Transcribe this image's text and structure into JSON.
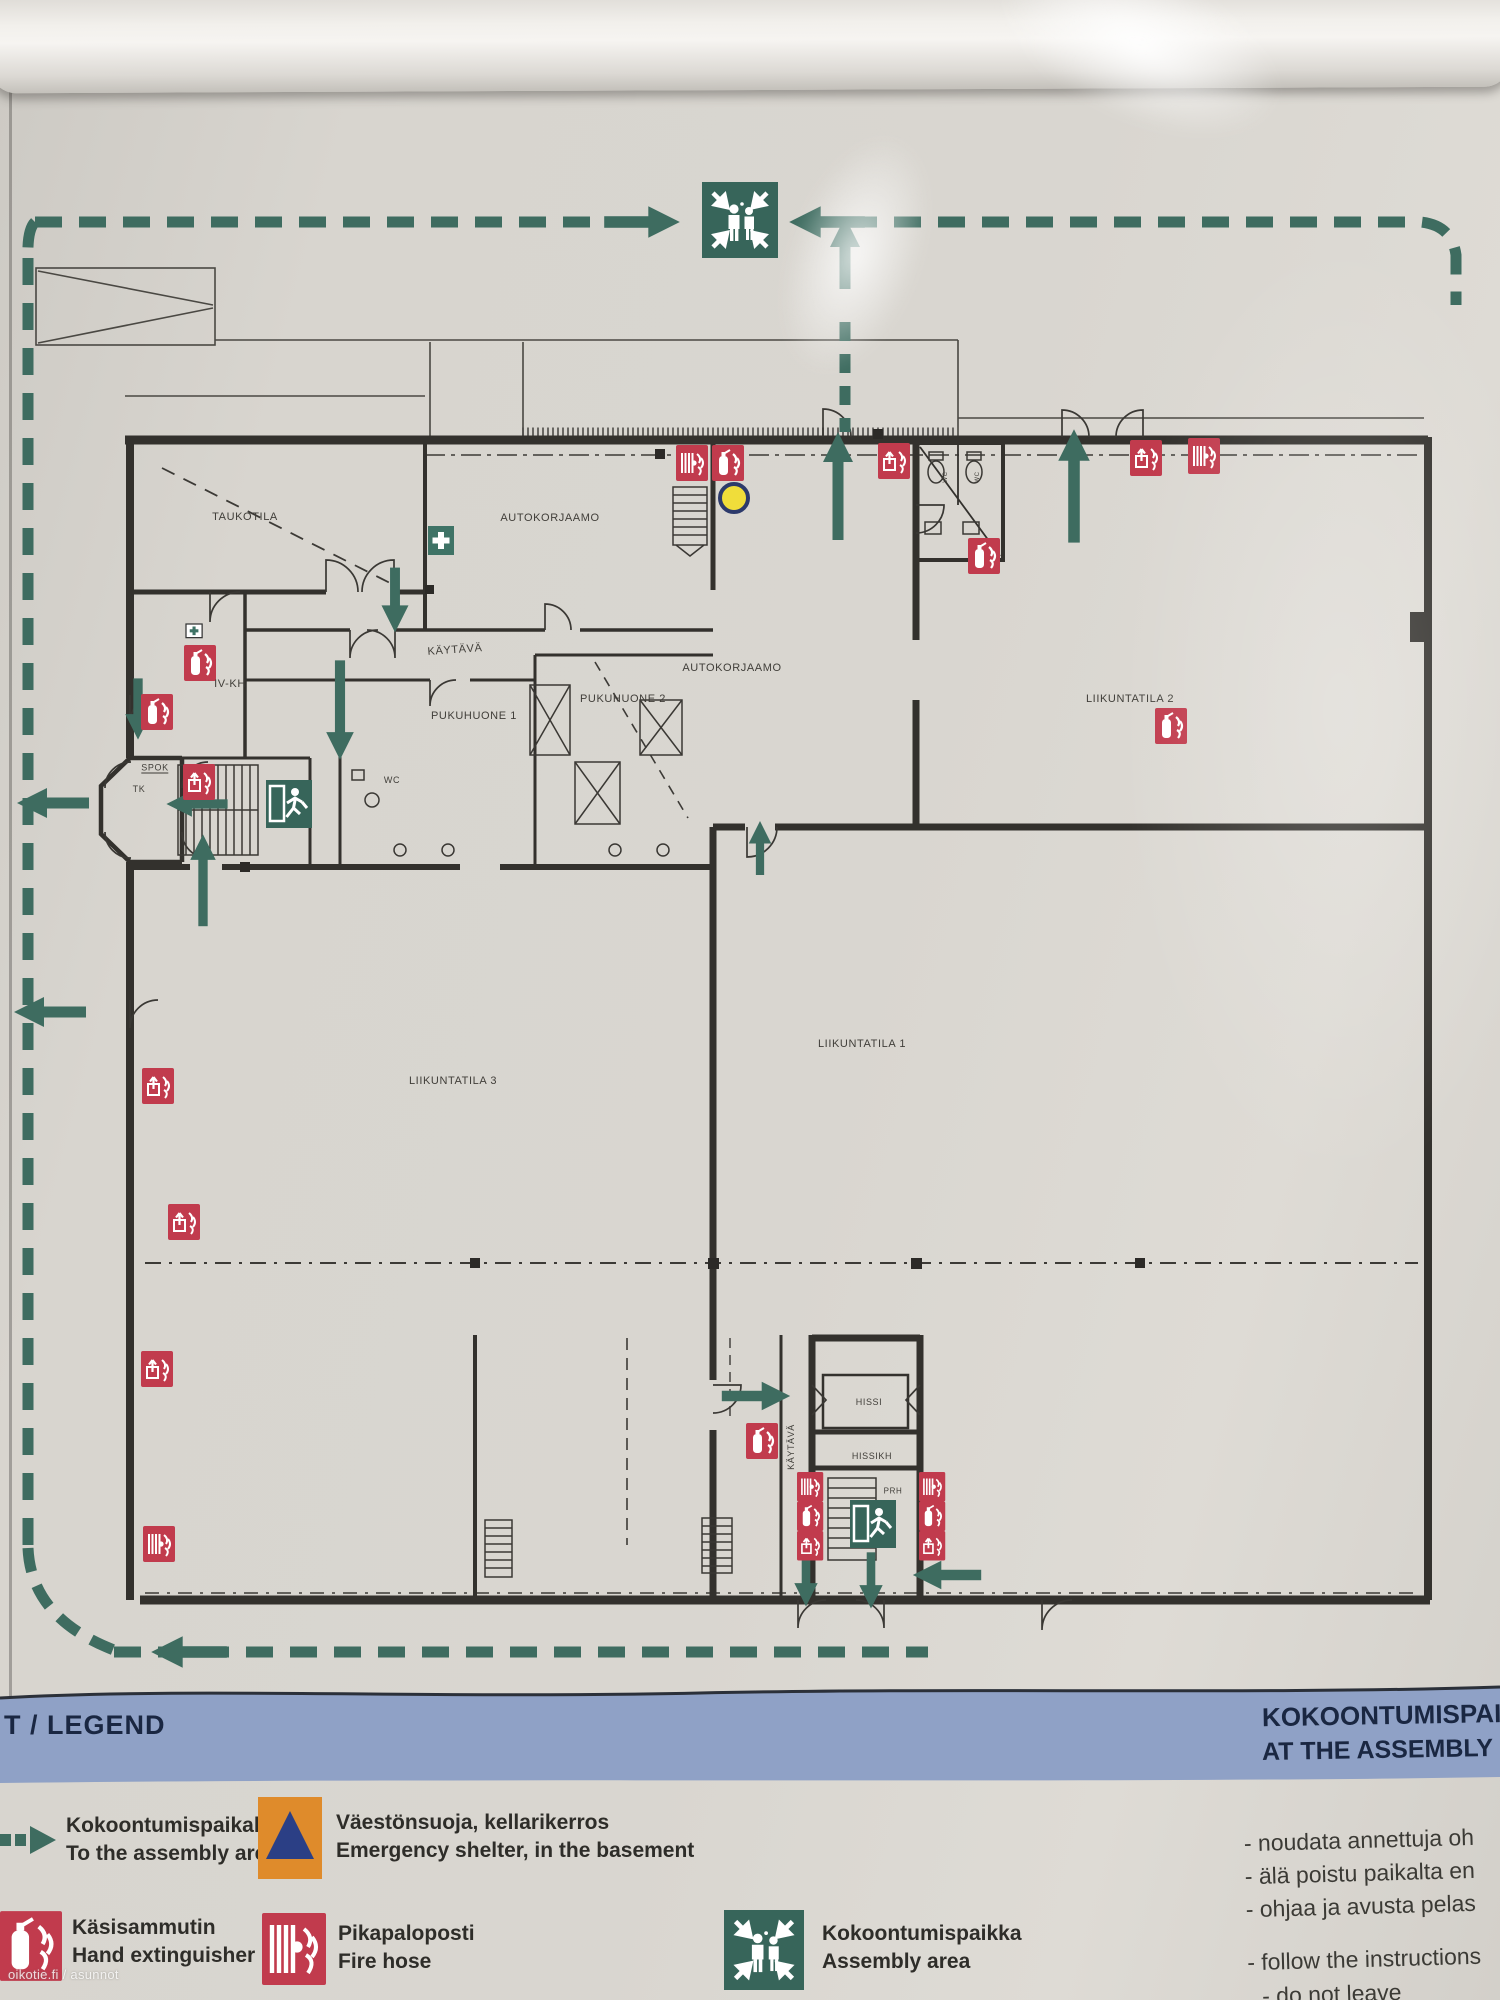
{
  "watermark": "oikotie.fi / asunnot",
  "banner": {
    "legend_title": "T / LEGEND",
    "assembly_title_line1": "KOKOONTUMISPAIK",
    "assembly_title_line2": "AT THE ASSEMBLY"
  },
  "legend": {
    "items": [
      {
        "icon": "route-arrow-icon",
        "fi": "Kokoontumispaikalle",
        "en": "To the assembly area"
      },
      {
        "icon": "shelter-triangle-icon",
        "fi": "Väestönsuoja, kellarikerros",
        "en": "Emergency shelter, in the basement"
      },
      {
        "icon": "hand-extinguisher-icon",
        "fi": "Käsisammutin",
        "en": "Hand extinguisher"
      },
      {
        "icon": "fire-hose-icon",
        "fi": "Pikapaloposti",
        "en": "Fire hose"
      },
      {
        "icon": "assembly-area-icon",
        "fi": "Kokoontumispaikka",
        "en": "Assembly area"
      }
    ]
  },
  "instructions": {
    "fi": [
      "- noudata annettuja oh",
      "- älä poistu paikalta en",
      "- ohjaa ja avusta pelas"
    ],
    "en": [
      "- follow the instructions",
      "- do not leave"
    ]
  },
  "plan": {
    "rooms": [
      {
        "label": "TAUKOTILA"
      },
      {
        "label": "AUTOKORJAAMO"
      },
      {
        "label": "KÄYTÄVÄ"
      },
      {
        "label": "IV-KH"
      },
      {
        "label": "PUKUHUONE 1"
      },
      {
        "label": "PUKUHUONE 2"
      },
      {
        "label": "AUTOKORJAAMO"
      },
      {
        "label": "WC"
      },
      {
        "label": "SPOK"
      },
      {
        "label": "TK"
      },
      {
        "label": "LIIKUNTATILA 2"
      },
      {
        "label": "LIIKUNTATILA 1"
      },
      {
        "label": "LIIKUNTATILA 3"
      },
      {
        "label": "HISSI"
      },
      {
        "label": "HISSIKH"
      },
      {
        "label": "PRH"
      },
      {
        "label": "KÄYTÄVÄ"
      },
      {
        "label": "WC"
      },
      {
        "label": "WC"
      }
    ],
    "marker": "you-are-here"
  },
  "colors": {
    "route_green": "#3e6c60",
    "sign_red": "#c13b4d",
    "banner_blue": "#8fa1c6",
    "shelter_orange": "#df8b2b",
    "shelter_triangle": "#2b3f85",
    "marker_yellow": "#f0dd3a"
  }
}
